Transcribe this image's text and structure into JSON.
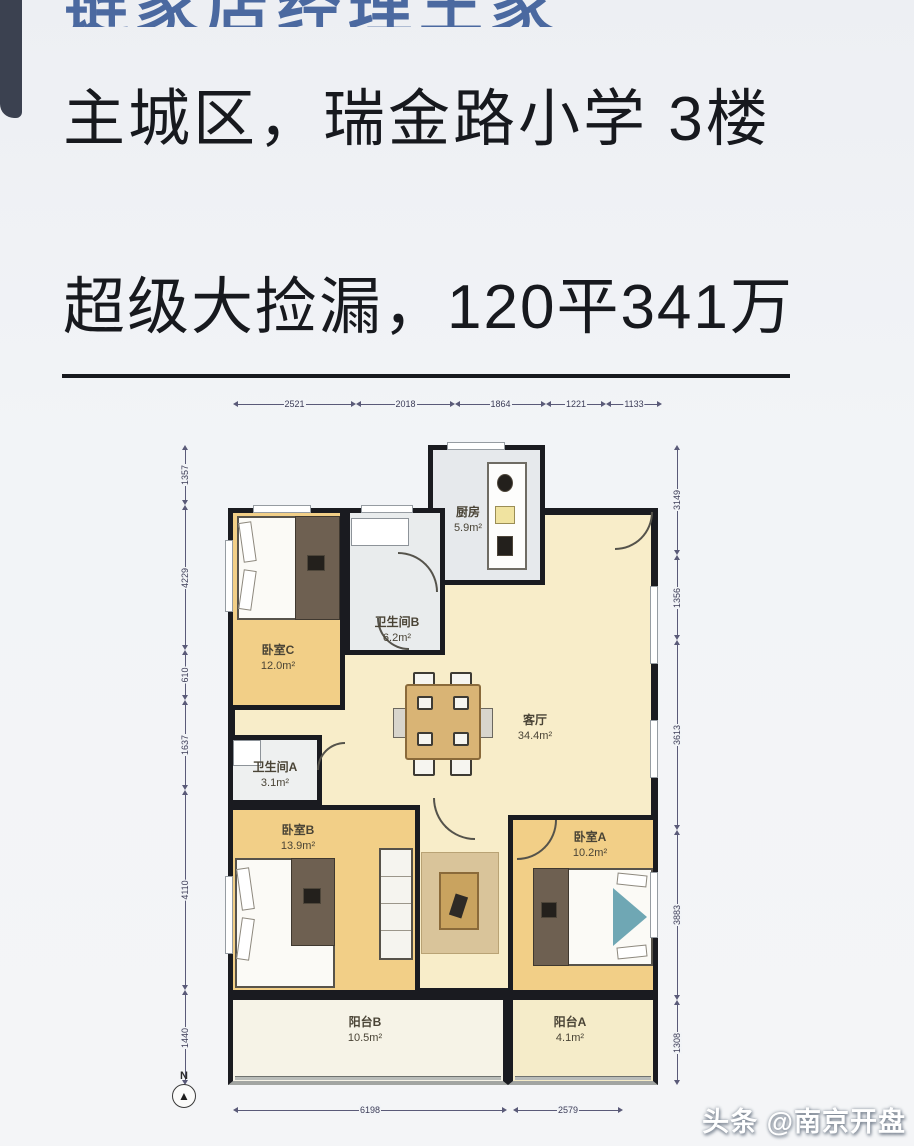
{
  "header": {
    "clipped_title": "链家店经理王家",
    "title_line1": "主城区，瑞金路小学 3楼",
    "title_line2": "超级大捡漏，120平341万"
  },
  "watermark": {
    "text": "头条 @南京开盘"
  },
  "colors": {
    "page_bg": "#f2f4f7",
    "accent_blue": "#4b69a0",
    "heading_text": "#17191e",
    "wall": "#1a1b20",
    "bedroom_fill": "#f2cf87",
    "living_fill": "#f8edc9",
    "wet_room_fill": "#e6e9ec",
    "balcony_fill": "#f6f3e7"
  },
  "floorplan": {
    "rooms": [
      {
        "id": "living",
        "name": "客厅",
        "area": "34.4m²"
      },
      {
        "id": "kitchen",
        "name": "厨房",
        "area": "5.9m²"
      },
      {
        "id": "bathroom-b",
        "name": "卫生间B",
        "area": "6.2m²"
      },
      {
        "id": "bedroom-c",
        "name": "卧室C",
        "area": "12.0m²"
      },
      {
        "id": "bathroom-a",
        "name": "卫生间A",
        "area": "3.1m²"
      },
      {
        "id": "bedroom-b",
        "name": "卧室B",
        "area": "13.9m²"
      },
      {
        "id": "bedroom-a",
        "name": "卧室A",
        "area": "10.2m²"
      },
      {
        "id": "balcony-b",
        "name": "阳台B",
        "area": "10.5m²"
      },
      {
        "id": "balcony-a",
        "name": "阳台A",
        "area": "4.1m²"
      }
    ],
    "dimensions": {
      "top": [
        "2521",
        "2018",
        "1864",
        "1221",
        "1133"
      ],
      "bottom": [
        "6198",
        "2579"
      ],
      "left": [
        "1357",
        "4229",
        "610",
        "1637",
        "4110",
        "1440"
      ],
      "right": [
        "3149",
        "1356",
        "3613",
        "3883",
        "1308"
      ]
    },
    "compass": "N"
  }
}
